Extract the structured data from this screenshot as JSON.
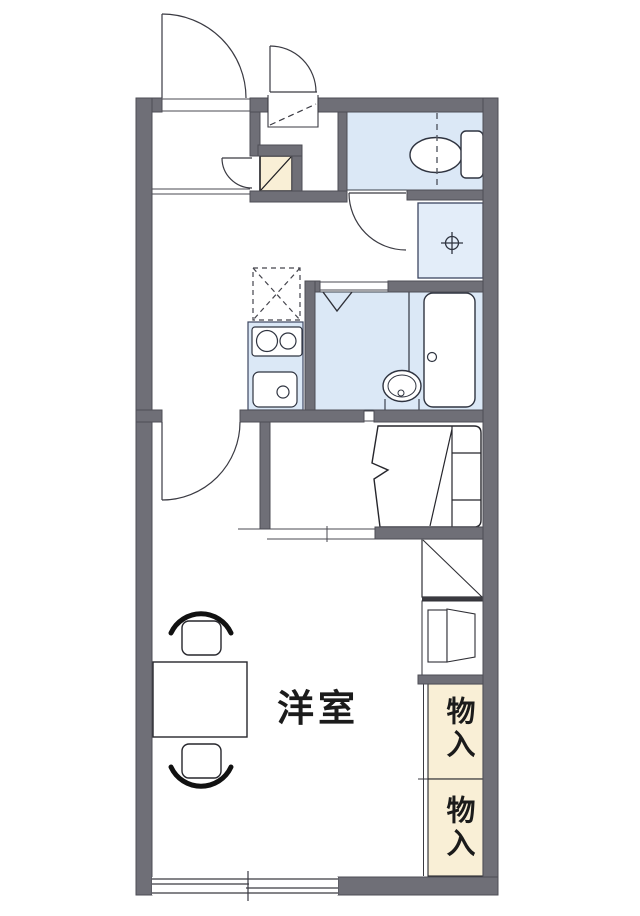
{
  "labels": {
    "western_room": "洋室",
    "storage_top": "物入",
    "storage_bottom": "物入"
  },
  "colors": {
    "background": "#ffffff",
    "wall": "#6f6f77",
    "wall_edge": "#4e4e56",
    "water_area": "#dbe8f6",
    "laundry_area": "#e3edf9",
    "storage_beige": "#f9efd6",
    "line": "#2f3038",
    "fixture_line": "#2f3440",
    "text": "#1b1b1b"
  }
}
